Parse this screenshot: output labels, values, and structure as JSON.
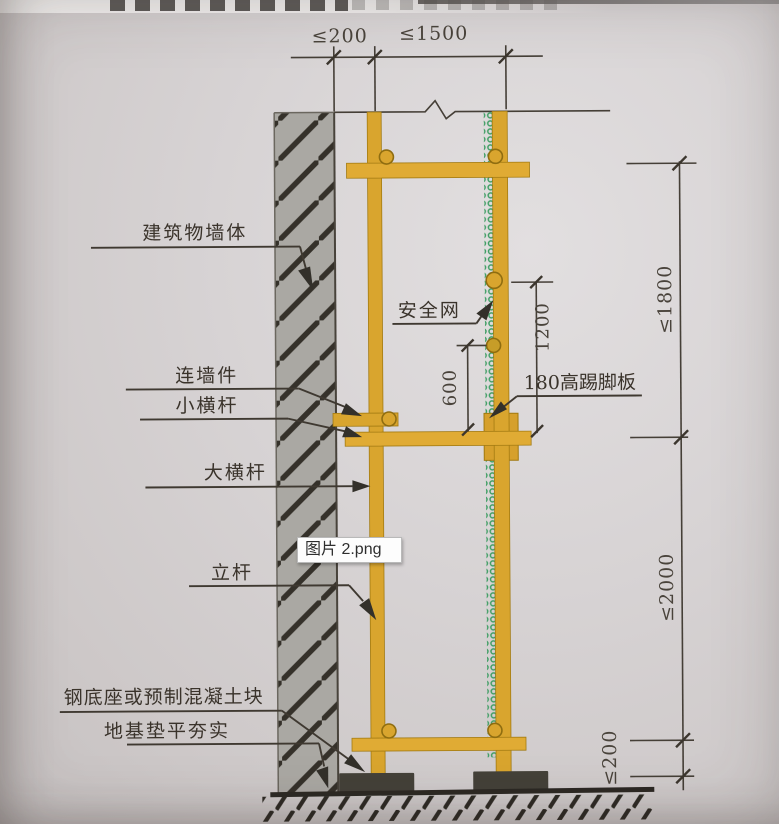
{
  "window": {
    "image_tooltip": "图片 2.png"
  },
  "diagram": {
    "labels": {
      "building_wall": "建筑物墙体",
      "wall_connector": "连墙件",
      "small_crossbar": "小横杆",
      "main_ledger": "大横杆",
      "safety_net": "安全网",
      "toe_board": "180高踢脚板",
      "standing_pole": "立杆",
      "steel_base": "钢底座或预制混凝土块",
      "ground_compacted": "地基垫平夯实"
    },
    "dimensions": {
      "top_wall_gap": "≤200",
      "top_bay": "≤1500",
      "right_top": "≤1800",
      "right_middle": "≤2000",
      "right_bottom": "≤200",
      "guardrail_height": "1200",
      "midrail_height": "600"
    },
    "colors": {
      "scaffold_yellow": "#d9a52e",
      "wall_gray": "#aaa8a3",
      "net_green": "#3e9d63",
      "line_dark": "#3f3931",
      "base_block": "#444139"
    }
  }
}
